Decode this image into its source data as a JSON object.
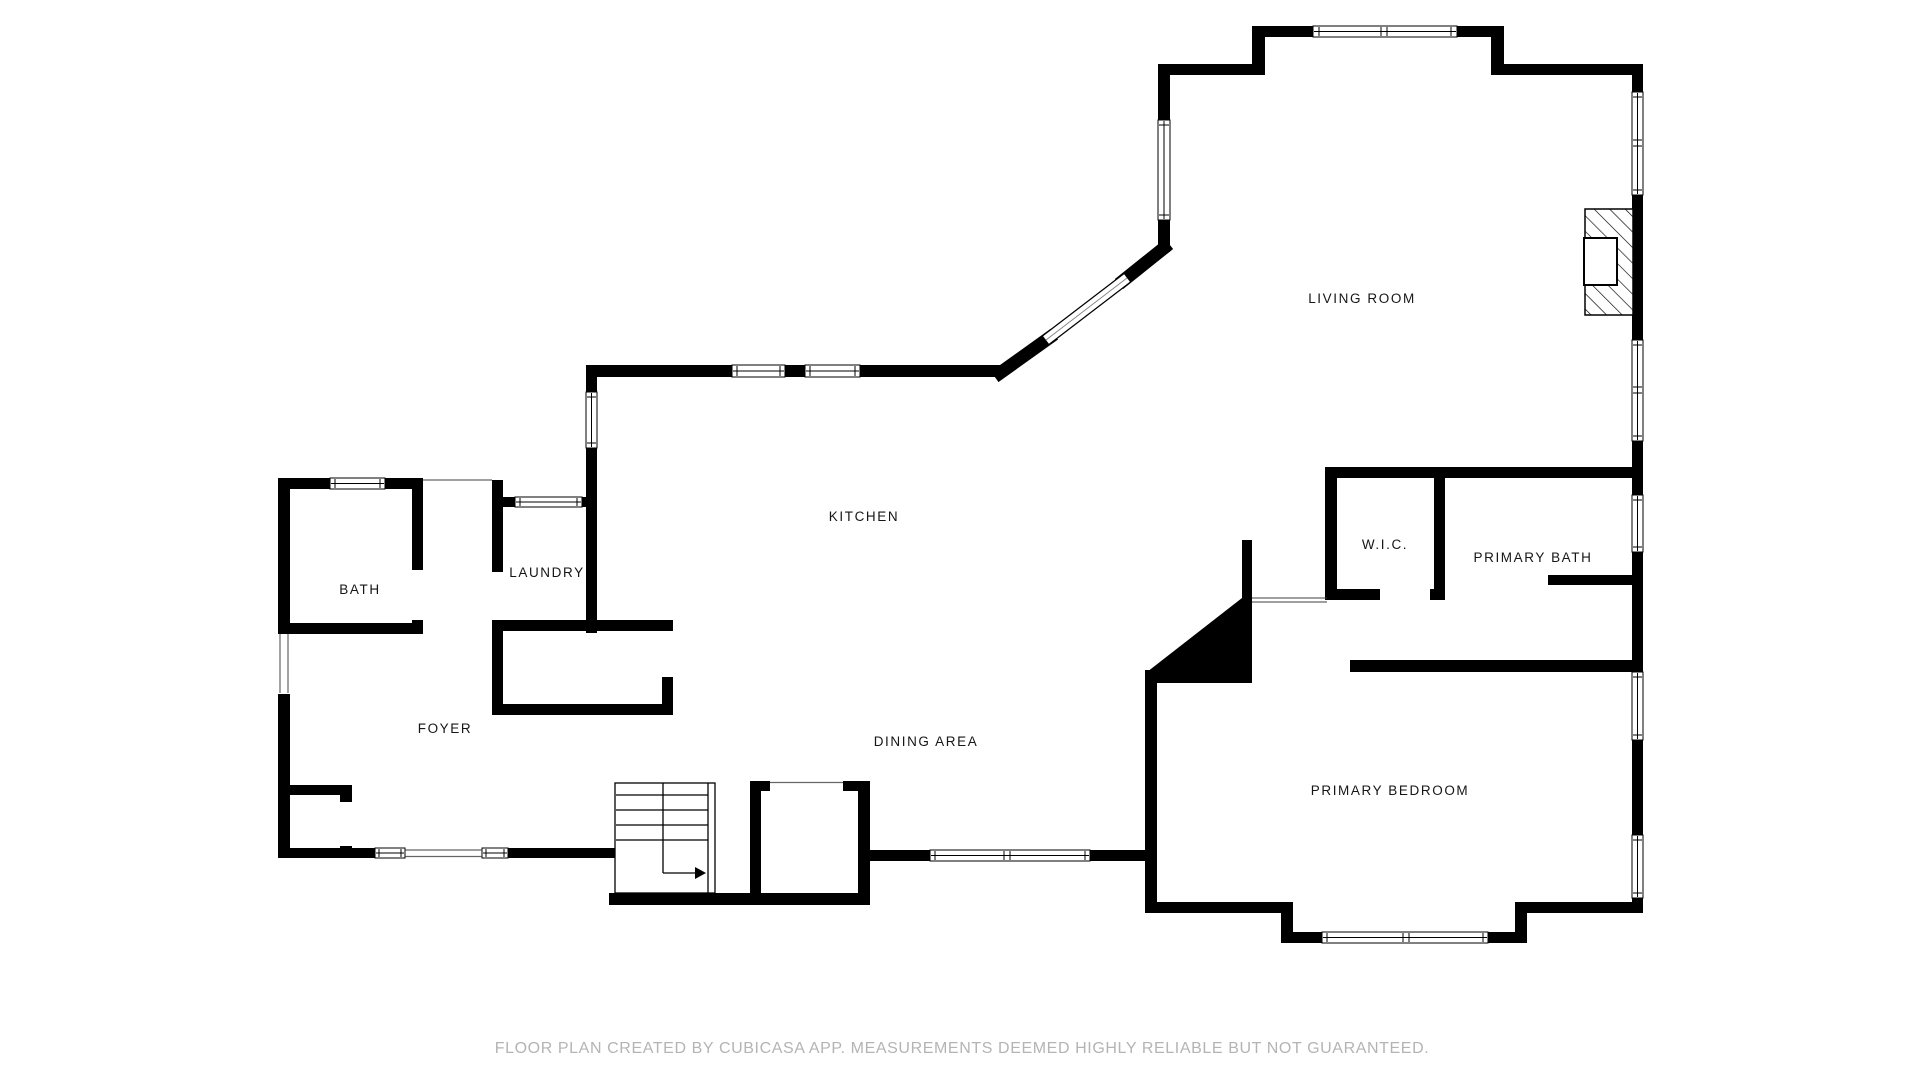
{
  "rooms": [
    {
      "name": "living-room",
      "label": "LIVING ROOM"
    },
    {
      "name": "kitchen",
      "label": "KITCHEN"
    },
    {
      "name": "dining-area",
      "label": "DINING AREA"
    },
    {
      "name": "foyer",
      "label": "FOYER"
    },
    {
      "name": "bath",
      "label": "BATH"
    },
    {
      "name": "laundry",
      "label": "LAUNDRY"
    },
    {
      "name": "wic",
      "label": "W.I.C."
    },
    {
      "name": "primary-bath",
      "label": "PRIMARY BATH"
    },
    {
      "name": "primary-bedroom",
      "label": "PRIMARY BEDROOM"
    }
  ],
  "footer": {
    "disclaimer": "FLOOR PLAN CREATED BY CUBICASA APP. MEASUREMENTS DEEMED HIGHLY RELIABLE BUT NOT GUARANTEED."
  },
  "icons": {
    "stairs": "staircase-with-up-arrow",
    "fireplace": "hatched-fireplace"
  },
  "colors": {
    "wall": "#000000",
    "room_label": "#161616",
    "footer_text": "#b4b4b4",
    "background": "#ffffff"
  }
}
